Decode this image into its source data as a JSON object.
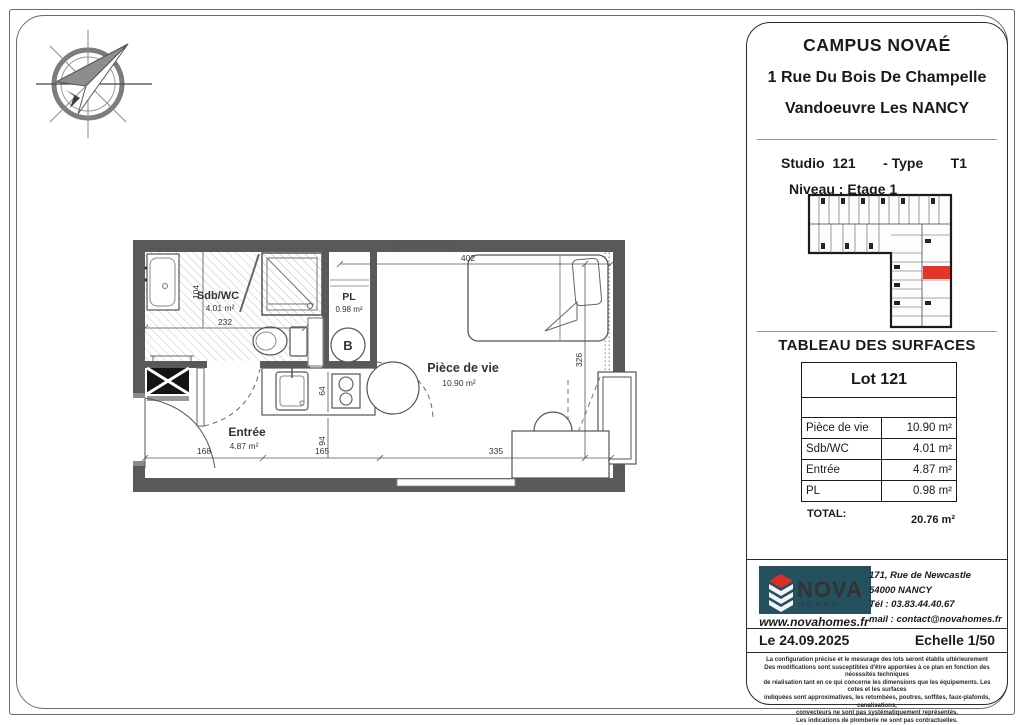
{
  "header": {
    "project": "CAMPUS NOVAÉ",
    "address_line1": "1 Rue Du Bois De Champelle",
    "address_line2": "Vandoeuvre Les NANCY"
  },
  "unit": {
    "studio_label": "Studio",
    "studio_number": "121",
    "type_label": "- Type",
    "type_value": "T1",
    "level": "Niveau : Etage 1"
  },
  "surface_table": {
    "title": "TABLEAU DES SURFACES",
    "lot_title": "Lot 121",
    "rows": [
      {
        "label": "Pièce de vie",
        "value": "10.90 m²"
      },
      {
        "label": "Sdb/WC",
        "value": "4.01 m²"
      },
      {
        "label": "Entrée",
        "value": "4.87 m²"
      },
      {
        "label": "PL",
        "value": "0.98 m²"
      }
    ],
    "total_label": "TOTAL:",
    "total_value": "20.76 m²"
  },
  "plan": {
    "rooms": {
      "sdb": {
        "name": "Sdb/WC",
        "area": "4.01 m²"
      },
      "pl": {
        "name": "PL",
        "area": "0.98 m²"
      },
      "vie": {
        "name": "Pièce de vie",
        "area": "10.90 m²"
      },
      "entree": {
        "name": "Entrée",
        "area": "4.87 m²"
      }
    },
    "boiler_label": "B",
    "dims": {
      "top_width": "402",
      "bath_width": "232",
      "bath_height": "104",
      "living_height": "326",
      "bottom_left": "168",
      "bottom_mid": "165",
      "bottom_right": "335",
      "kitchen_depth": "64",
      "entry_depth": "94"
    }
  },
  "company": {
    "name": "NOVA",
    "sub_name": "HOMES",
    "website": "www.novahomes.fr",
    "address1": "171, Rue de Newcastle",
    "address2": "54000 NANCY",
    "tel": "Tél : 03.83.44.40.67",
    "mail": "mail : contact@novahomes.fr"
  },
  "footer": {
    "date": "Le 24.09.2025",
    "scale": "Echelle 1/50"
  },
  "disclaimer": {
    "lines": [
      "La configuration précise et le mesurage des lots seront établis ultérieurement",
      "Des modifications sont susceptibles d'être apportées à ce plan en fonction des nécessités techniques",
      "de réalisation tant en ce qui concerne les dimensions que les équipements. Les cotes et les surfaces",
      "indiquées sont approximatives, les retombées, poutres, soffites, faux-plafonds, canalisations,",
      "convecteurs ne sont pas systématiquement représentés.",
      "Les indications de plomberie ne sont pas contractuelles."
    ]
  },
  "colors": {
    "wall": "#58595b",
    "highlight_red": "#e5332a",
    "logo_background": "#25505f"
  }
}
